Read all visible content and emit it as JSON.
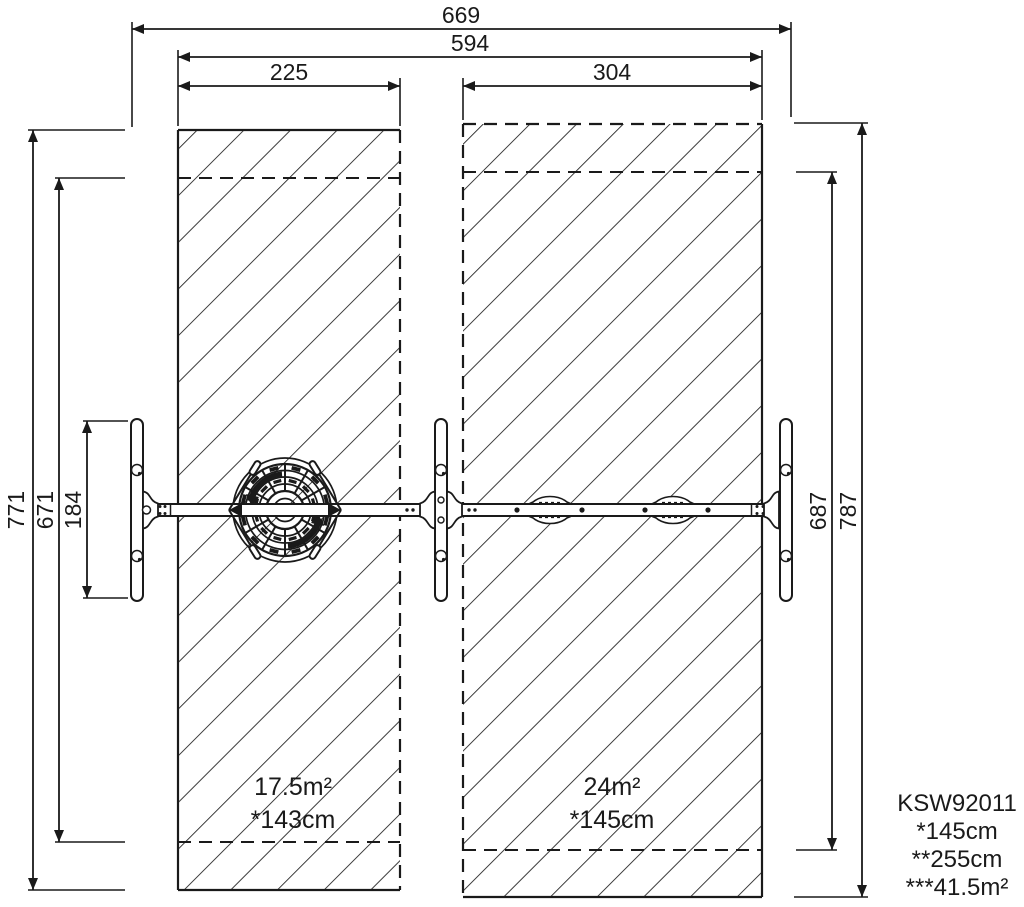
{
  "drawing_title": "KSW92011 swing set top view safety-zone drawing",
  "dimensions": {
    "total_width": "669",
    "safety_zone_width": "594",
    "left_zone_width": "225",
    "right_zone_width": "304",
    "left_zone_height": "771",
    "left_inner_height": "671",
    "frame_footprint_depth": "184",
    "right_inner_height": "687",
    "right_zone_height": "787"
  },
  "zones": {
    "left": {
      "area": "17.5m²",
      "fall_height": "*143cm"
    },
    "right": {
      "area": "24m²",
      "fall_height": "*145cm"
    }
  },
  "legend": {
    "product_code": "KSW92011",
    "line_swing_height": "*145cm",
    "line_beam_height": "**255cm",
    "line_total_area": "***41.5m²"
  },
  "colors": {
    "line": "#1a1a1a",
    "background": "#ffffff"
  }
}
